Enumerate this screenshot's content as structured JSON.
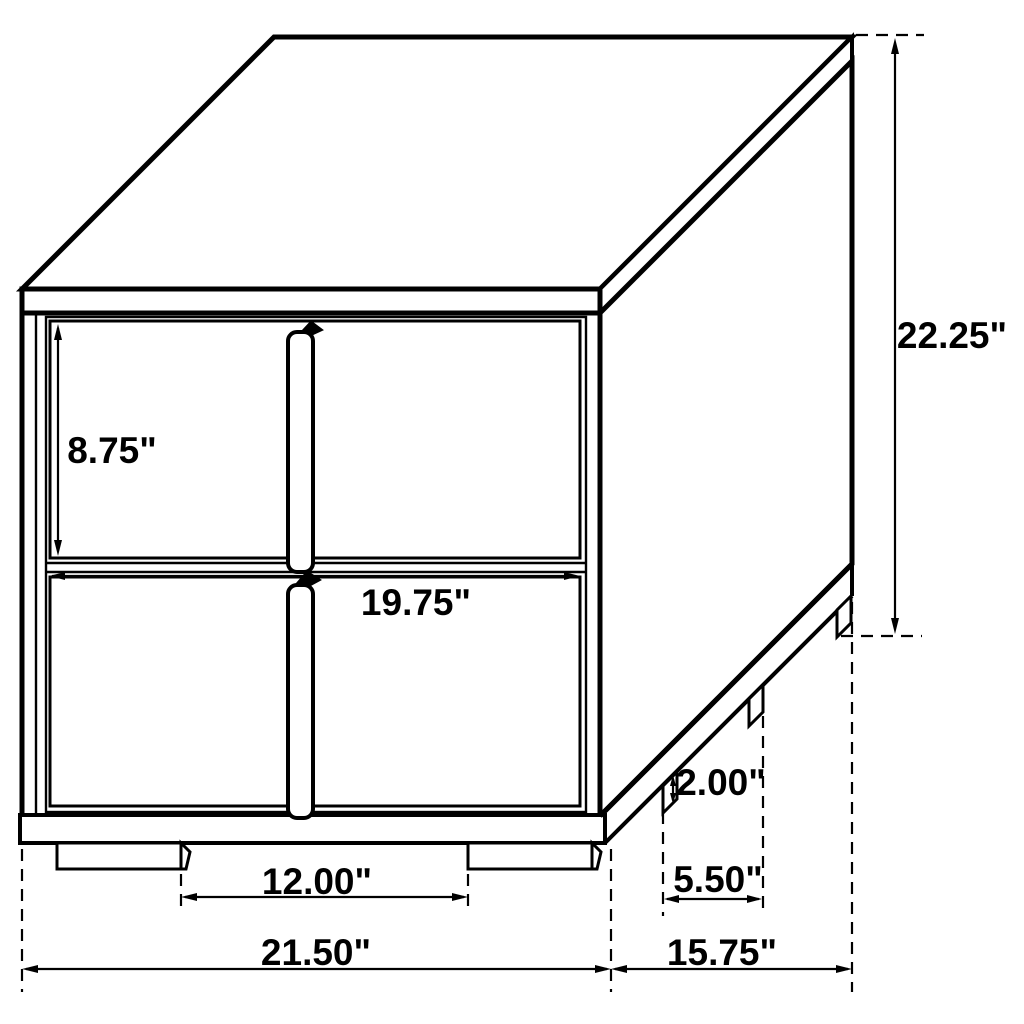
{
  "diagram": {
    "type": "furniture-technical-drawing",
    "subject": "two-drawer nightstand with center pull handles, isometric line drawing",
    "background_color": "#ffffff",
    "line_color": "#000000"
  },
  "dimensions": {
    "drawer_height": "8.75\"",
    "front_width_inner": "19.75\"",
    "overall_height": "22.25\"",
    "foot_height": "2.00\"",
    "side_feet_spacing": "5.50\"",
    "front_feet_spacing": "12.00\"",
    "overall_width": "21.50\"",
    "overall_depth": "15.75\""
  }
}
